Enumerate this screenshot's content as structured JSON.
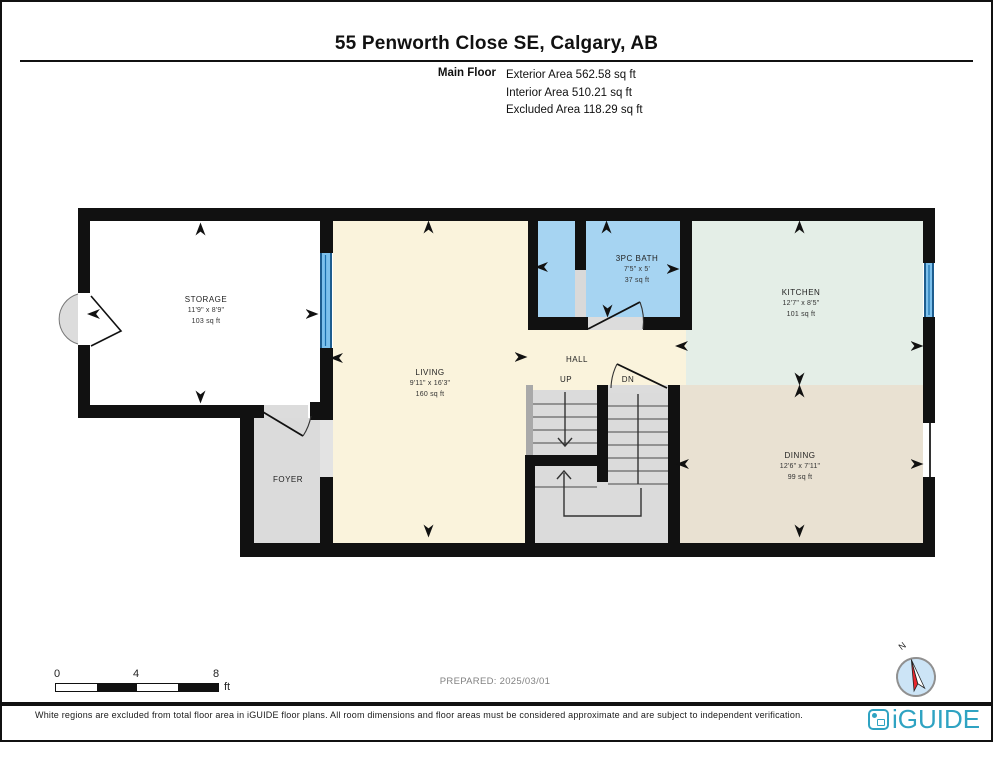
{
  "header": {
    "title": "55 Penworth Close SE, Calgary, AB",
    "floor_label": "Main Floor",
    "stats": [
      "Exterior Area 562.58 sq ft",
      "Interior Area 510.21 sq ft",
      "Excluded Area 118.29 sq ft"
    ]
  },
  "rooms": {
    "storage": {
      "name": "STORAGE",
      "dims": "11'9\" x 8'9\"",
      "area": "103 sq ft"
    },
    "living": {
      "name": "LIVING",
      "dims": "9'11\" x 16'3\"",
      "area": "160 sq ft"
    },
    "bath": {
      "name": "3PC BATH",
      "dims": "7'5\" x 5'",
      "area": "37 sq ft"
    },
    "kitchen": {
      "name": "KITCHEN",
      "dims": "12'7\" x 8'5\"",
      "area": "101 sq ft"
    },
    "dining": {
      "name": "DINING",
      "dims": "12'6\" x 7'11\"",
      "area": "99 sq ft"
    },
    "hall": {
      "name": "HALL"
    },
    "foyer": {
      "name": "FOYER"
    }
  },
  "stairs": {
    "up_label": "UP",
    "down_label": "DN"
  },
  "scale_bar": {
    "ticks": [
      "0",
      "4",
      "8"
    ],
    "unit": "ft"
  },
  "prepared": "PREPARED: 2025/03/01",
  "compass": {
    "north_label": "N"
  },
  "footer": {
    "disclaimer": "White regions are excluded from total floor area in iGUIDE floor plans. All room dimensions and floor areas must be considered approximate and are subject to independent verification.",
    "brand": "iGUIDE"
  },
  "colors": {
    "wall": "#111111",
    "living": "#FAF3DC",
    "bath": "#A6D4F2",
    "kitchen": "#E4EEE7",
    "dining": "#E9E1D2",
    "circulation": "#DBDBDB",
    "window": "#5FA8DC",
    "brand": "#2FA3C2"
  }
}
